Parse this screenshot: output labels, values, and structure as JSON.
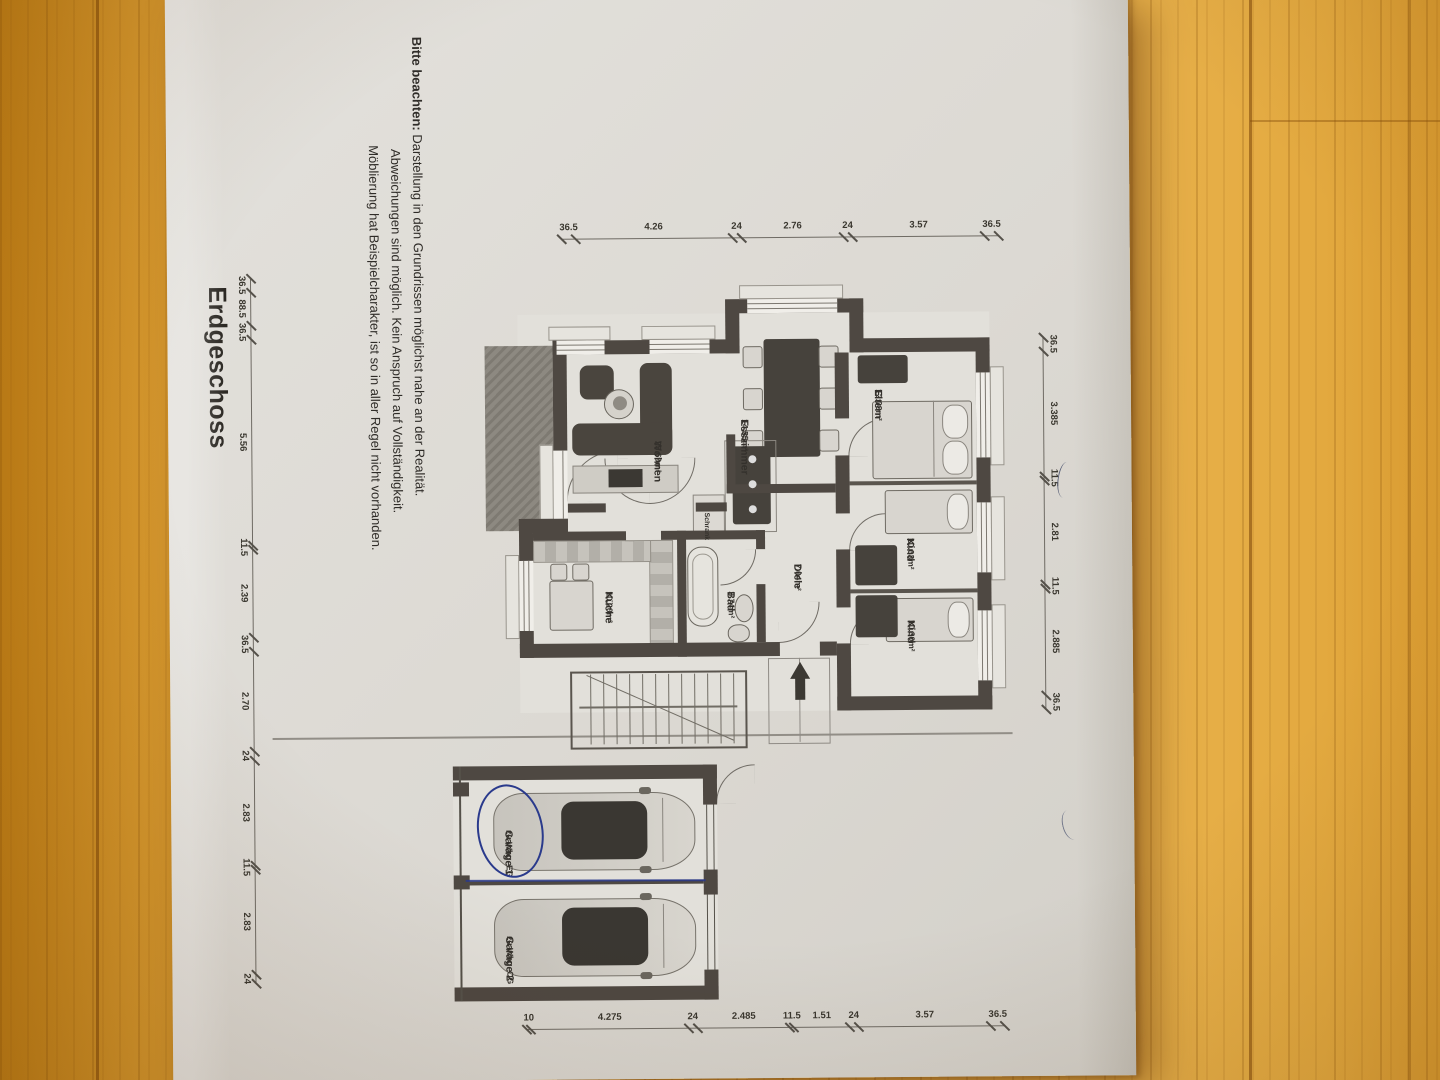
{
  "title": "Erdgeschoss",
  "note": {
    "bold": "Bitte beachten:",
    "line1_rest": " Darstellung in den Grundrissen möglichst nahe an der Realität.",
    "line2": "Abweichungen sind möglich. Kein Anspruch auf Vollständigkeit.",
    "line3": "Möblierung hat Beispielcharakter, ist so in aller Regel nicht vorhanden."
  },
  "plan": {
    "room_labels": [
      {
        "id": "eltern",
        "name": "Eltern",
        "area": "12.08m²",
        "cx": 396,
        "cy": 247
      },
      {
        "id": "kind-1",
        "name": "Kind",
        "area": "10.03m²",
        "cx": 545,
        "cy": 216
      },
      {
        "id": "kind-2",
        "name": "Kind",
        "area": "10.30m²",
        "cx": 627,
        "cy": 216
      },
      {
        "id": "esszimmer",
        "name": "Esszimmer",
        "area": "14.55m²",
        "cx": 425,
        "cy": 381
      },
      {
        "id": "wohnen",
        "name": "Wohnen",
        "area": "23.69m²",
        "cx": 446,
        "cy": 468
      },
      {
        "id": "kueche",
        "name": "Küche",
        "area": "10.20m²",
        "cx": 596,
        "cy": 518
      },
      {
        "id": "bad",
        "name": "Bad",
        "area": "3.74m²",
        "cx": 597,
        "cy": 396
      },
      {
        "id": "diele",
        "name": "Diele",
        "area": "7.04m²",
        "cx": 570,
        "cy": 329
      },
      {
        "id": "schrank",
        "name": "Schrank",
        "area": "",
        "cx": 518,
        "cy": 421,
        "small": true
      },
      {
        "id": "garage-1",
        "name": "Garage 1",
        "sub": "zu Whg. EG",
        "cx": 834,
        "cy": 620
      },
      {
        "id": "garage-2",
        "name": "Garage 2",
        "sub": "zu Whg. OG",
        "cx": 940,
        "cy": 620
      }
    ],
    "dim_chains": [
      {
        "id": "left-chain",
        "dir": "v",
        "pos": 243,
        "side": "left",
        "segs": [
          {
            "v": "36.5",
            "a": 130,
            "b": 144
          },
          {
            "v": "3.57",
            "a": 144,
            "b": 276
          },
          {
            "v": "24",
            "a": 276,
            "b": 285
          },
          {
            "v": "2.76",
            "a": 285,
            "b": 387
          },
          {
            "v": "24",
            "a": 387,
            "b": 396
          },
          {
            "v": "4.26",
            "a": 396,
            "b": 553
          },
          {
            "v": "36.5",
            "a": 553,
            "b": 567
          }
        ]
      },
      {
        "id": "top-chain",
        "dir": "h",
        "pos": 86,
        "side": "above",
        "segs": [
          {
            "v": "36.5",
            "a": 345,
            "b": 359
          },
          {
            "v": "3.385",
            "a": 359,
            "b": 484
          },
          {
            "v": "11.5",
            "a": 484,
            "b": 488
          },
          {
            "v": "2.81",
            "a": 488,
            "b": 592
          },
          {
            "v": "11.5",
            "a": 592,
            "b": 596
          },
          {
            "v": "2.885",
            "a": 596,
            "b": 703
          },
          {
            "v": "36.5",
            "a": 703,
            "b": 717
          }
        ]
      },
      {
        "id": "right-chain",
        "dir": "v",
        "pos": 1033,
        "side": "left",
        "segs": [
          {
            "v": "36.5",
            "a": 130,
            "b": 144
          },
          {
            "v": "3.57",
            "a": 144,
            "b": 276
          },
          {
            "v": "24",
            "a": 276,
            "b": 285
          },
          {
            "v": "1.51",
            "a": 285,
            "b": 341
          },
          {
            "v": "11.5",
            "a": 341,
            "b": 345
          },
          {
            "v": "2.485",
            "a": 345,
            "b": 437
          },
          {
            "v": "24",
            "a": 437,
            "b": 446
          },
          {
            "v": "4.275",
            "a": 446,
            "b": 604
          },
          {
            "v": "10",
            "a": 604,
            "b": 608
          }
        ]
      },
      {
        "id": "bottom-chain",
        "dir": "h",
        "pos": 878,
        "side": "below",
        "segs": [
          {
            "v": "36.5",
            "a": 280,
            "b": 294
          },
          {
            "v": "88.5",
            "a": 294,
            "b": 327
          },
          {
            "v": "36.5",
            "a": 327,
            "b": 341
          },
          {
            "v": "5.56",
            "a": 341,
            "b": 547
          },
          {
            "v": "11.5",
            "a": 547,
            "b": 551
          },
          {
            "v": "2.39",
            "a": 551,
            "b": 639
          },
          {
            "v": "36.5",
            "a": 639,
            "b": 653
          },
          {
            "v": "2.70",
            "a": 653,
            "b": 753
          },
          {
            "v": "24",
            "a": 753,
            "b": 762
          },
          {
            "v": "2.83",
            "a": 762,
            "b": 867
          },
          {
            "v": "11.5",
            "a": 867,
            "b": 871
          },
          {
            "v": "2.83",
            "a": 871,
            "b": 976
          },
          {
            "v": "24",
            "a": 976,
            "b": 985
          }
        ]
      }
    ]
  },
  "colors": {
    "wall": "#4e4842",
    "paper": "#dcd9d3",
    "wood": "#e2a73f",
    "pen_blue": "#2a3a8c",
    "dim": "#6f6b64"
  }
}
